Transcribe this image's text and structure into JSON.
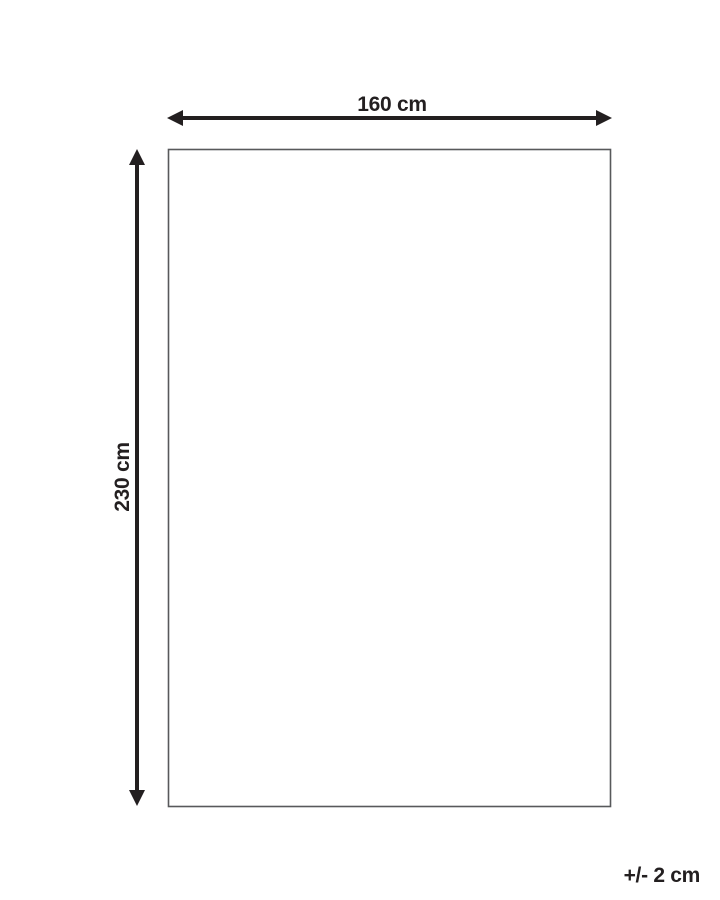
{
  "diagram": {
    "width_label": "160 cm",
    "height_label": "230 cm",
    "tolerance_label": "+/- 2 cm",
    "colors": {
      "ink": "#231f20",
      "outline": "#58595b",
      "background": "#ffffff"
    }
  }
}
